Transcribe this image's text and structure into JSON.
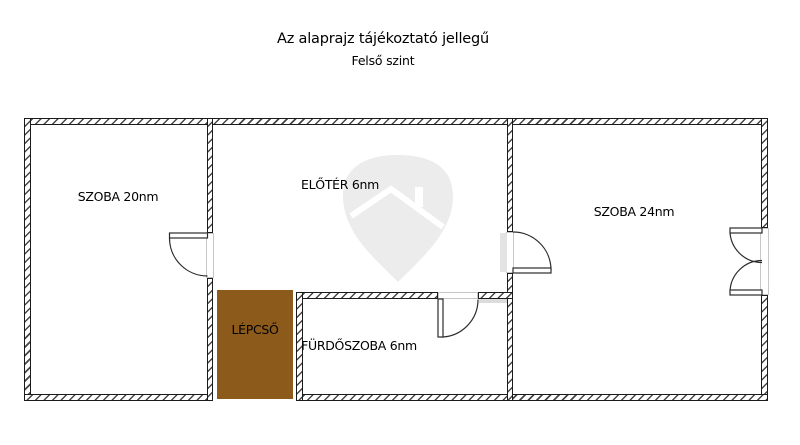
{
  "header": {
    "title": "Az alaprajz tájékoztató jellegű",
    "subtitle": "Felső szint"
  },
  "floorplan": {
    "rooms": [
      {
        "key": "szoba20",
        "label": "SZOBA 20nm"
      },
      {
        "key": "eloter",
        "label": "ELŐTÉR 6nm"
      },
      {
        "key": "szoba24",
        "label": "SZOBA 24nm"
      },
      {
        "key": "furdoszoba",
        "label": "FÜRDŐSZOBA 6nm"
      },
      {
        "key": "lepcso",
        "label": "LÉPCSŐ"
      }
    ],
    "colors": {
      "stairs_fill": "#8c5a1a",
      "wall_line": "#1b1b1b",
      "watermark_fill": "#ececec",
      "label_text": "#000000"
    }
  }
}
